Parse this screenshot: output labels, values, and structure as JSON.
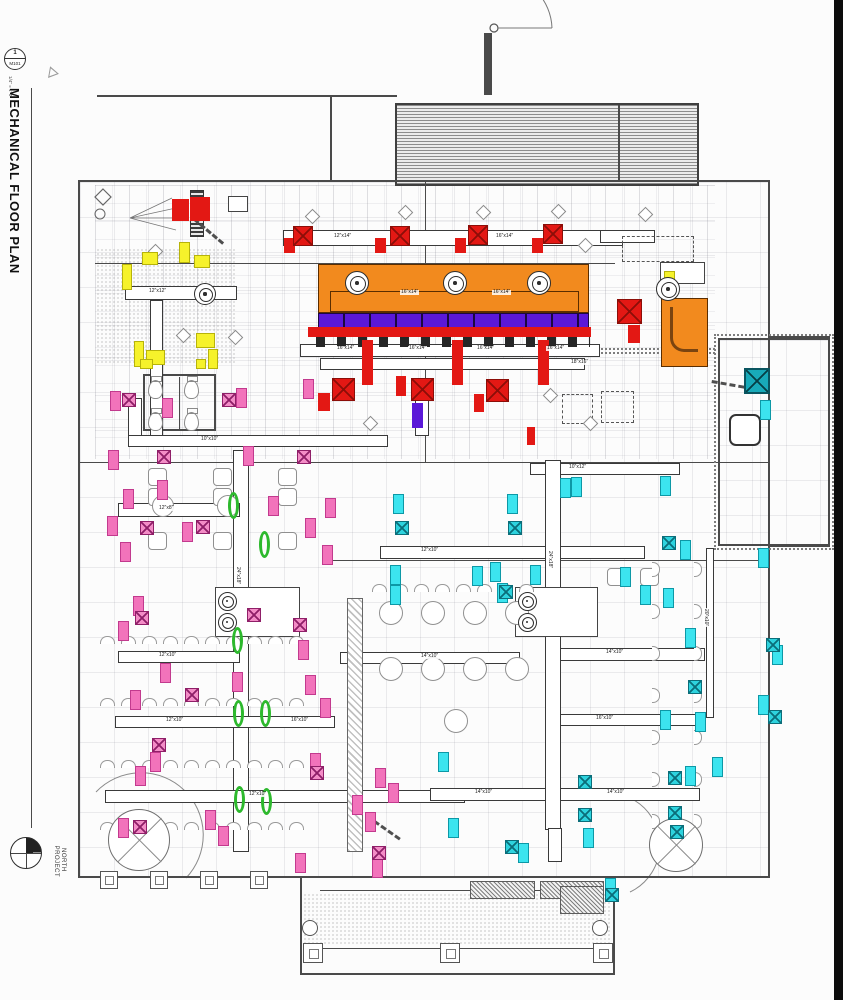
{
  "sidebar": {
    "detail_number": "1",
    "sheet_ref": "M101",
    "title": "MECHANICAL FLOOR PLAN",
    "scale": "1/4\" = 1'-0\"",
    "north": {
      "word1": "PROJECT",
      "word2": "NORTH"
    }
  },
  "colors": {
    "exhaust_red": "#e31814",
    "hood_orange": "#f28a1e",
    "band_purple": "#5b18d8",
    "supply_pink": "#f273bb",
    "supply_cyan": "#3ce4ef",
    "diffuser_teal": "#18aab9",
    "tag_yellow": "#f6f22b",
    "highlight_green": "#2db92d"
  },
  "plan": {
    "walls": [
      [
        78,
        180,
        692,
        2
      ],
      [
        78,
        180,
        2,
        698
      ],
      [
        768,
        180,
        2,
        698
      ],
      [
        78,
        876,
        692,
        2
      ],
      [
        300,
        878,
        2,
        97
      ],
      [
        613,
        878,
        2,
        97
      ],
      [
        300,
        973,
        315,
        2
      ],
      [
        320,
        890,
        275,
        1
      ],
      [
        303,
        948,
        308,
        1
      ],
      [
        770,
        336,
        60,
        2
      ],
      [
        770,
        545,
        60,
        2
      ],
      [
        828,
        336,
        2,
        211
      ],
      [
        718,
        338,
        2,
        208
      ],
      [
        718,
        338,
        110,
        2
      ],
      [
        718,
        544,
        110,
        2
      ],
      [
        97,
        95,
        300,
        2
      ],
      [
        330,
        97,
        2,
        85
      ],
      [
        484,
        33,
        8,
        62
      ],
      [
        95,
        263,
        520,
        1
      ],
      [
        78,
        462,
        690,
        1
      ],
      [
        330,
        560,
        438,
        1
      ],
      [
        143,
        374,
        73,
        2
      ],
      [
        143,
        429,
        73,
        2
      ],
      [
        143,
        374,
        2,
        57
      ],
      [
        214,
        374,
        2,
        57
      ],
      [
        179,
        377,
        1,
        53
      ],
      [
        425,
        182,
        1,
        280
      ],
      [
        31,
        88,
        1,
        740
      ]
    ],
    "grids": [
      [
        80,
        182,
        688,
        694
      ],
      [
        718,
        340,
        110,
        204
      ],
      [
        95,
        185,
        620,
        274
      ]
    ],
    "roof_hatch": [
      395,
      103,
      300,
      79
    ],
    "roof_hatch_divider": [
      618,
      105,
      2,
      75
    ],
    "ducts": [
      [
        283,
        230,
        340,
        16
      ],
      [
        125,
        286,
        112,
        14
      ],
      [
        150,
        300,
        13,
        136
      ],
      [
        128,
        435,
        260,
        12
      ],
      [
        530,
        463,
        150,
        12
      ],
      [
        233,
        450,
        16,
        402
      ],
      [
        118,
        503,
        122,
        14
      ],
      [
        380,
        546,
        265,
        13
      ],
      [
        118,
        651,
        122,
        12
      ],
      [
        545,
        648,
        160,
        13
      ],
      [
        340,
        652,
        180,
        12
      ],
      [
        115,
        716,
        220,
        12
      ],
      [
        545,
        714,
        160,
        12
      ],
      [
        105,
        790,
        360,
        13
      ],
      [
        430,
        788,
        270,
        13
      ],
      [
        545,
        460,
        16,
        370
      ],
      [
        706,
        548,
        8,
        170
      ],
      [
        300,
        344,
        300,
        13
      ],
      [
        320,
        358,
        265,
        12
      ],
      [
        128,
        398,
        14,
        38
      ],
      [
        415,
        398,
        14,
        38
      ],
      [
        600,
        230,
        55,
        13
      ],
      [
        548,
        828,
        14,
        34
      ]
    ],
    "labels": [
      [
        "12″x14″",
        333,
        234,
        0
      ],
      [
        "16″x14″",
        495,
        234,
        0
      ],
      [
        "12″x12″",
        148,
        289,
        0
      ],
      [
        "10″x10″",
        200,
        437,
        0
      ],
      [
        "10″x12″",
        568,
        465,
        0
      ],
      [
        "12″x8″",
        158,
        506,
        0
      ],
      [
        "12″x10″",
        420,
        548,
        0
      ],
      [
        "12″x10″",
        158,
        653,
        0
      ],
      [
        "14″x10″",
        420,
        654,
        0
      ],
      [
        "14″x10″",
        605,
        650,
        0
      ],
      [
        "12″x10″",
        165,
        718,
        0
      ],
      [
        "16″x10″",
        290,
        718,
        0
      ],
      [
        "16″x10″",
        595,
        716,
        0
      ],
      [
        "12″x10″",
        248,
        792,
        0
      ],
      [
        "14″x10″",
        474,
        790,
        0
      ],
      [
        "14″x10″",
        606,
        790,
        0
      ],
      [
        "16″x14″",
        336,
        346,
        0
      ],
      [
        "16″x14″",
        408,
        346,
        0
      ],
      [
        "16″x14″",
        476,
        346,
        0
      ],
      [
        "16″x14″",
        546,
        346,
        0
      ],
      [
        "18″x16″",
        570,
        360,
        0
      ],
      [
        "16″x14″",
        400,
        290,
        0
      ],
      [
        "16″x14″",
        492,
        290,
        0
      ],
      [
        "24″x18″",
        240,
        566,
        90
      ],
      [
        "24″x18″",
        552,
        550,
        90
      ],
      [
        "20″x10″",
        708,
        608,
        90
      ]
    ],
    "hood": {
      "box": [
        318,
        264,
        271,
        49
      ],
      "purple_band": [
        318,
        313,
        271,
        15
      ],
      "collars": [
        316,
        337,
        274,
        10
      ],
      "elbow": [
        661,
        298,
        47,
        69
      ]
    },
    "markers": {
      "red": [
        [
          172,
          199,
          17,
          22
        ],
        [
          190,
          197,
          20,
          24
        ],
        [
          284,
          238,
          11,
          15
        ],
        [
          375,
          238,
          11,
          15
        ],
        [
          455,
          238,
          11,
          15
        ],
        [
          532,
          238,
          11,
          15
        ],
        [
          628,
          325,
          12,
          18
        ],
        [
          362,
          340,
          11,
          45
        ],
        [
          452,
          340,
          11,
          45
        ],
        [
          538,
          340,
          11,
          45
        ],
        [
          318,
          393,
          12,
          18
        ],
        [
          396,
          376,
          10,
          20
        ],
        [
          474,
          394,
          10,
          18
        ],
        [
          527,
          427,
          8,
          18
        ],
        [
          308,
          327,
          283,
          10
        ]
      ],
      "red_x": [
        [
          293,
          226,
          20
        ],
        [
          390,
          226,
          20
        ],
        [
          468,
          225,
          20
        ],
        [
          543,
          224,
          20
        ],
        [
          332,
          378,
          23
        ],
        [
          411,
          378,
          23
        ],
        [
          486,
          379,
          23
        ],
        [
          617,
          299,
          25
        ]
      ],
      "pink": [
        [
          110,
          391
        ],
        [
          236,
          388
        ],
        [
          303,
          379
        ],
        [
          108,
          450
        ],
        [
          243,
          446
        ],
        [
          157,
          480
        ],
        [
          123,
          489
        ],
        [
          107,
          516
        ],
        [
          182,
          522
        ],
        [
          305,
          518
        ],
        [
          120,
          542
        ],
        [
          268,
          496
        ],
        [
          322,
          545
        ],
        [
          133,
          596
        ],
        [
          118,
          621
        ],
        [
          298,
          640
        ],
        [
          160,
          663
        ],
        [
          130,
          690
        ],
        [
          305,
          675
        ],
        [
          320,
          698
        ],
        [
          150,
          752
        ],
        [
          310,
          753
        ],
        [
          375,
          768
        ],
        [
          118,
          818
        ],
        [
          205,
          810
        ],
        [
          352,
          795
        ],
        [
          365,
          812
        ],
        [
          295,
          853
        ],
        [
          372,
          858
        ],
        [
          218,
          826
        ],
        [
          388,
          783
        ],
        [
          162,
          398
        ],
        [
          325,
          498
        ],
        [
          232,
          672
        ],
        [
          135,
          766
        ]
      ],
      "pink_x": [
        [
          122,
          393
        ],
        [
          222,
          393
        ],
        [
          157,
          450
        ],
        [
          140,
          521
        ],
        [
          196,
          520
        ],
        [
          247,
          608
        ],
        [
          135,
          611
        ],
        [
          293,
          618
        ],
        [
          185,
          688
        ],
        [
          310,
          766
        ],
        [
          133,
          820
        ],
        [
          372,
          846
        ],
        [
          152,
          738
        ],
        [
          297,
          450
        ]
      ],
      "cyan": [
        [
          393,
          494
        ],
        [
          507,
          494
        ],
        [
          390,
          565
        ],
        [
          390,
          585
        ],
        [
          472,
          566
        ],
        [
          490,
          562
        ],
        [
          571,
          477
        ],
        [
          660,
          476
        ],
        [
          680,
          540
        ],
        [
          663,
          588
        ],
        [
          685,
          628
        ],
        [
          660,
          710
        ],
        [
          712,
          757
        ],
        [
          758,
          548
        ],
        [
          772,
          645
        ],
        [
          758,
          695
        ],
        [
          438,
          752
        ],
        [
          448,
          818
        ],
        [
          518,
          843
        ],
        [
          583,
          828
        ],
        [
          685,
          766
        ],
        [
          695,
          712
        ],
        [
          760,
          400
        ],
        [
          497,
          583
        ],
        [
          530,
          565
        ],
        [
          605,
          878
        ],
        [
          560,
          478
        ],
        [
          620,
          567
        ],
        [
          640,
          585
        ]
      ],
      "cyan_x": [
        [
          395,
          521
        ],
        [
          508,
          521
        ],
        [
          578,
          775
        ],
        [
          578,
          808
        ],
        [
          668,
          771
        ],
        [
          668,
          806
        ],
        [
          670,
          825
        ],
        [
          505,
          840
        ],
        [
          605,
          888
        ],
        [
          662,
          536
        ],
        [
          766,
          638
        ],
        [
          768,
          710
        ],
        [
          688,
          680
        ],
        [
          499,
          585
        ]
      ],
      "teal_x": [
        [
          744,
          368,
          26
        ]
      ],
      "yellow": [
        [
          122,
          264,
          10,
          26
        ],
        [
          142,
          252,
          16,
          13
        ],
        [
          179,
          242,
          11,
          21
        ],
        [
          194,
          255,
          16,
          13
        ],
        [
          134,
          341,
          10,
          26
        ],
        [
          146,
          350,
          19,
          15
        ],
        [
          196,
          333,
          19,
          15
        ],
        [
          140,
          359,
          13,
          10
        ],
        [
          196,
          359,
          10,
          10
        ],
        [
          664,
          271,
          11,
          13
        ],
        [
          208,
          349,
          10,
          20
        ]
      ],
      "green": [
        [
          228,
          492
        ],
        [
          259,
          531
        ],
        [
          232,
          627
        ],
        [
          233,
          700
        ],
        [
          260,
          700
        ],
        [
          234,
          786
        ],
        [
          261,
          788
        ]
      ],
      "purple_bar": [
        [
          412,
          403,
          11,
          25
        ]
      ]
    },
    "fans": [
      [
        357,
        283,
        24
      ],
      [
        455,
        283,
        24
      ],
      [
        539,
        283,
        24
      ],
      [
        205,
        294,
        22
      ],
      [
        668,
        289,
        24
      ],
      [
        227,
        601,
        19
      ],
      [
        227,
        622,
        19
      ],
      [
        527,
        601,
        19
      ],
      [
        527,
        622,
        19
      ]
    ],
    "equip": [
      [
        215,
        587,
        85,
        50
      ],
      [
        515,
        587,
        83,
        50
      ],
      [
        228,
        196,
        20,
        16
      ],
      [
        660,
        262,
        45,
        22
      ]
    ],
    "equipD": [
      [
        562,
        394,
        31,
        30
      ],
      [
        601,
        391,
        33,
        32
      ],
      [
        622,
        236,
        72,
        26
      ]
    ],
    "equipX": [
      [
        405,
        281,
        30,
        32
      ]
    ],
    "equipR": [
      [
        729,
        414,
        32,
        32
      ]
    ],
    "shafts": [
      [
        190,
        190,
        12,
        45
      ]
    ],
    "counters": [
      [
        347,
        598,
        14,
        252
      ]
    ],
    "toilets": [
      [
        148,
        380
      ],
      [
        184,
        380
      ],
      [
        148,
        412
      ],
      [
        184,
        412
      ]
    ],
    "booths": [
      [
        148,
        468
      ],
      [
        148,
        488
      ],
      [
        213,
        468
      ],
      [
        213,
        488
      ],
      [
        278,
        468
      ],
      [
        278,
        488
      ],
      [
        148,
        532
      ],
      [
        213,
        532
      ],
      [
        278,
        532
      ],
      [
        607,
        568
      ],
      [
        640,
        568
      ]
    ],
    "tablesC": [
      [
        390,
        612,
        22
      ],
      [
        432,
        612,
        22
      ],
      [
        474,
        612,
        22
      ],
      [
        516,
        612,
        22
      ],
      [
        390,
        668,
        22
      ],
      [
        432,
        668,
        22
      ],
      [
        474,
        668,
        22
      ],
      [
        516,
        668,
        22
      ],
      [
        455,
        720,
        22
      ],
      [
        162,
        505,
        20
      ],
      [
        227,
        505,
        20
      ]
    ],
    "seatRowsH": [
      [
        100,
        636,
        10
      ],
      [
        100,
        698,
        10
      ],
      [
        100,
        760,
        10
      ],
      [
        100,
        822,
        10
      ],
      [
        372,
        584,
        8
      ]
    ],
    "seatRowsV": [
      [
        652,
        562,
        7
      ],
      [
        694,
        562,
        7
      ]
    ],
    "circlesX": [
      [
        139,
        840,
        31
      ],
      [
        676,
        845,
        27
      ]
    ],
    "hexTags": [
      [
        307,
        211
      ],
      [
        400,
        207
      ],
      [
        478,
        207
      ],
      [
        553,
        206
      ],
      [
        640,
        209
      ],
      [
        150,
        246
      ],
      [
        545,
        390
      ],
      [
        580,
        240
      ],
      [
        365,
        418
      ],
      [
        585,
        418
      ],
      [
        178,
        330
      ],
      [
        230,
        332
      ]
    ],
    "flex": [
      [
        195,
        218,
        38,
        40
      ],
      [
        712,
        380,
        42,
        10
      ],
      [
        368,
        815,
        40,
        35
      ]
    ],
    "stipples": [
      [
        303,
        893,
        308,
        52
      ],
      [
        96,
        248,
        140,
        115
      ]
    ],
    "planters": [
      [
        470,
        881,
        63,
        16
      ],
      [
        540,
        881,
        62,
        16
      ],
      [
        560,
        886,
        42,
        26
      ]
    ],
    "clouds": [
      [
        714,
        334,
        120,
        216
      ],
      [
        597,
        348,
        118,
        6
      ]
    ],
    "columnsSq": [
      [
        303,
        943,
        20
      ],
      [
        440,
        943,
        20
      ],
      [
        593,
        943,
        20
      ],
      [
        100,
        871,
        18
      ],
      [
        150,
        871,
        18
      ],
      [
        200,
        871,
        18
      ],
      [
        250,
        871,
        18
      ]
    ],
    "columnsC": [
      [
        310,
        928,
        16
      ],
      [
        600,
        928,
        16
      ]
    ],
    "black_strip": [
      834,
      0,
      9,
      1000
    ]
  }
}
